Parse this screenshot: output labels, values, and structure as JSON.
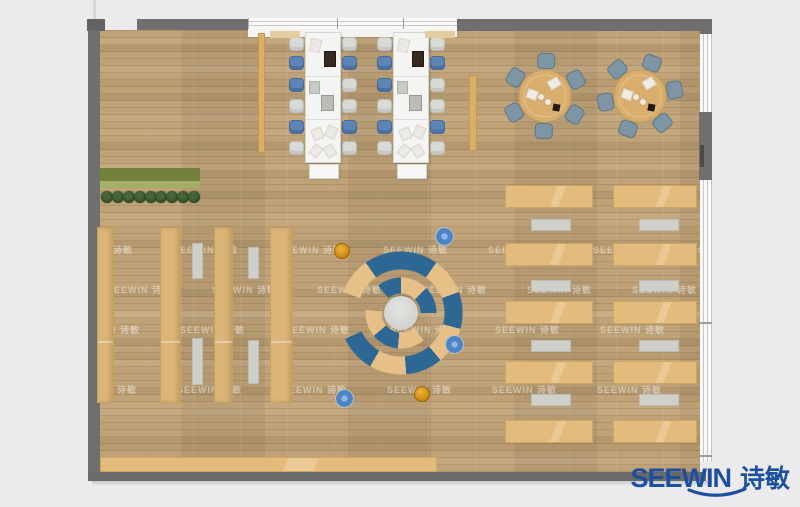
{
  "page": {
    "background": "#ebebed"
  },
  "brand": {
    "name": "SEEWIN",
    "cn": "诗敏",
    "color": "#1d4fa1"
  },
  "watermark": {
    "text": "SEEWIN 诗敏",
    "step": 105,
    "rows": [
      {
        "y": 243,
        "x0": 68
      },
      {
        "y": 283,
        "x0": 2
      },
      {
        "y": 323,
        "x0": -30
      },
      {
        "y": 383,
        "x0": 72
      }
    ]
  },
  "colors": {
    "floor_wood": "#bfa277",
    "wall": "#6f6f70",
    "desk_white": "#f4f4f2",
    "chair_blue": "#5d84b5",
    "chair_gray": "#d8dad6",
    "chair_slate": "#7e95a5",
    "round_table_wood": "#d9ae6c",
    "bench_blue": "#2d6793",
    "bench_tan": "#e7c088",
    "shelf_wood": "#dcb579",
    "reading_desk_wood": "#e3bb7d",
    "bench_gray": "#d0d0ca",
    "planter_green": "#72813b",
    "tree_green": "#2c4a24",
    "stool_orange": "#cf8c12",
    "stool_blue": "#4b85c7",
    "logo_blue": "#1d4fa1"
  },
  "plan": {
    "workstations": {
      "clusters": [
        {
          "x": 305
        },
        {
          "x": 393
        }
      ],
      "desk": {
        "y": 32,
        "w": 36,
        "h": 131
      },
      "seams": [
        43,
        86
      ],
      "chair_ys": [
        37,
        56,
        78,
        99,
        120,
        141
      ],
      "left_colors": [
        "gray",
        "blue",
        "blue",
        "gray",
        "blue",
        "gray"
      ],
      "right_colors": [
        "gray",
        "blue",
        "gray",
        "gray",
        "blue",
        "gray"
      ],
      "items": [
        {
          "cls": "paper",
          "x": 4,
          "y": 6,
          "w": 9,
          "h": 11,
          "r": 12
        },
        {
          "cls": "dark",
          "x": 18,
          "y": 18,
          "w": 10,
          "h": 14,
          "r": 0
        },
        {
          "cls": "panel",
          "x": 3,
          "y": 48,
          "w": 9,
          "h": 11,
          "r": 0
        },
        {
          "cls": "monitor",
          "x": 15,
          "y": 62,
          "w": 11,
          "h": 14,
          "r": 0
        },
        {
          "cls": "paper",
          "x": 6,
          "y": 95,
          "w": 9,
          "h": 10,
          "r": -18
        },
        {
          "cls": "paper",
          "x": 20,
          "y": 93,
          "w": 9,
          "h": 10,
          "r": 25
        },
        {
          "cls": "paper",
          "x": 5,
          "y": 112,
          "w": 8,
          "h": 10,
          "r": 40
        },
        {
          "cls": "paper",
          "x": 19,
          "y": 112,
          "w": 8,
          "h": 10,
          "r": -30
        }
      ]
    },
    "side_benches": [
      {
        "x": 258,
        "y": 33,
        "w": 7,
        "h": 120
      },
      {
        "x": 469,
        "y": 75,
        "w": 8,
        "h": 76
      }
    ],
    "sill_accents": [
      {
        "x": 270,
        "y": 31,
        "w": 30,
        "h": 7
      },
      {
        "x": 425,
        "y": 31,
        "w": 30,
        "h": 7
      }
    ],
    "round_tables": [
      {
        "cx": 545,
        "cy": 96,
        "r": 26,
        "chair_angles": [
          88,
          148,
          208,
          268,
          328,
          28
        ]
      },
      {
        "cx": 640,
        "cy": 96,
        "r": 26,
        "chair_angles": [
          70,
          130,
          190,
          250,
          310,
          10
        ]
      }
    ],
    "stacks": {
      "y": 227,
      "h": 176,
      "cols": [
        {
          "x": 97,
          "w": 17
        },
        {
          "x": 160,
          "w": 21
        },
        {
          "x": 214,
          "w": 19
        },
        {
          "x": 270,
          "w": 23
        }
      ],
      "benches": [
        {
          "x": 192,
          "y": 243,
          "w": 9,
          "h": 34
        },
        {
          "x": 192,
          "y": 338,
          "w": 9,
          "h": 45
        },
        {
          "x": 248,
          "y": 247,
          "w": 9,
          "h": 30
        },
        {
          "x": 248,
          "y": 340,
          "w": 9,
          "h": 42
        }
      ]
    },
    "reading": {
      "cols": [
        {
          "x": 505,
          "w": 88
        },
        {
          "x": 613,
          "w": 84
        }
      ],
      "row_ys": [
        185,
        243,
        301,
        361,
        420
      ],
      "desk_h": 23,
      "bench_ys": [
        219,
        280,
        340,
        394
      ],
      "bench_w": 38,
      "bench_h": 10,
      "bench_offset": 26
    },
    "planter": {
      "x": 100,
      "y": 168,
      "w": 100,
      "h": 20,
      "tree_count": 9,
      "tree_y": 191
    },
    "bottom_desk": {
      "x": 100,
      "y": 457,
      "w": 337,
      "h": 15
    },
    "lounge": {
      "cx": 401,
      "cy": 313
    },
    "stools": [
      {
        "type": "orange",
        "x": 342,
        "y": 251
      },
      {
        "type": "orange",
        "x": 422,
        "y": 394
      },
      {
        "type": "blue",
        "x": 443,
        "y": 235
      },
      {
        "type": "blue",
        "x": 453,
        "y": 343
      },
      {
        "type": "blue",
        "x": 343,
        "y": 397
      }
    ]
  }
}
